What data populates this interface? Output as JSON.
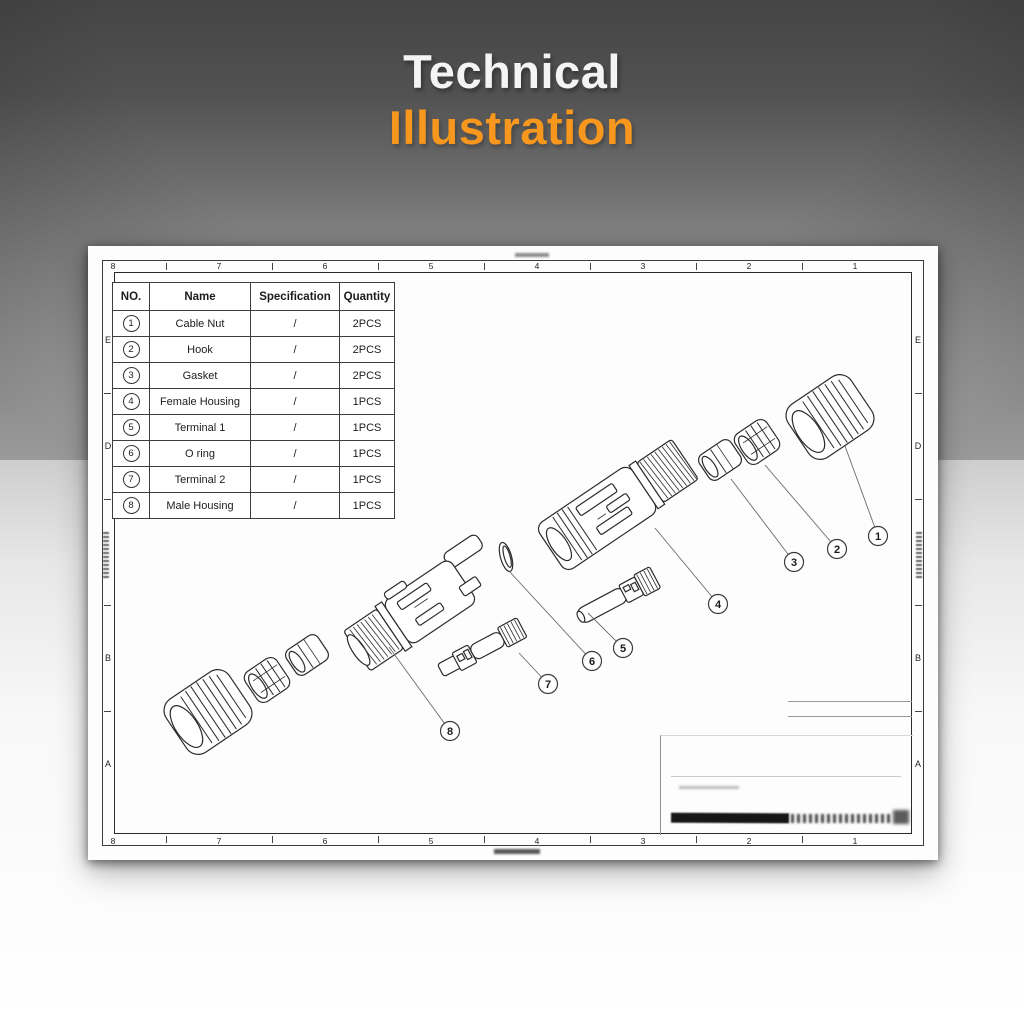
{
  "title": {
    "line1": "Technical",
    "line2": "Illustration"
  },
  "colors": {
    "accent": "#f8971d"
  },
  "sheet": {
    "top_ruler": [
      "8",
      "7",
      "6",
      "5",
      "4",
      "3",
      "2",
      "1"
    ],
    "bottom_ruler": [
      "8",
      "7",
      "6",
      "5",
      "4",
      "3",
      "2",
      "1"
    ],
    "left_ruler": [
      "E",
      "D",
      "",
      "B",
      "A"
    ],
    "right_ruler": [
      "E",
      "D",
      "",
      "B",
      "A"
    ],
    "table": {
      "headers": [
        "NO.",
        "Name",
        "Specification",
        "Quantity"
      ],
      "rows": [
        {
          "no": "1",
          "name": "Cable Nut",
          "spec": "/",
          "qty": "2PCS"
        },
        {
          "no": "2",
          "name": "Hook",
          "spec": "/",
          "qty": "2PCS"
        },
        {
          "no": "3",
          "name": "Gasket",
          "spec": "/",
          "qty": "2PCS"
        },
        {
          "no": "4",
          "name": "Female Housing",
          "spec": "/",
          "qty": "1PCS"
        },
        {
          "no": "5",
          "name": "Terminal 1",
          "spec": "/",
          "qty": "1PCS"
        },
        {
          "no": "6",
          "name": "O ring",
          "spec": "/",
          "qty": "1PCS"
        },
        {
          "no": "7",
          "name": "Terminal 2",
          "spec": "/",
          "qty": "1PCS"
        },
        {
          "no": "8",
          "name": "Male Housing",
          "spec": "/",
          "qty": "1PCS"
        }
      ]
    },
    "callouts": [
      "1",
      "2",
      "3",
      "4",
      "5",
      "6",
      "7",
      "8"
    ]
  }
}
